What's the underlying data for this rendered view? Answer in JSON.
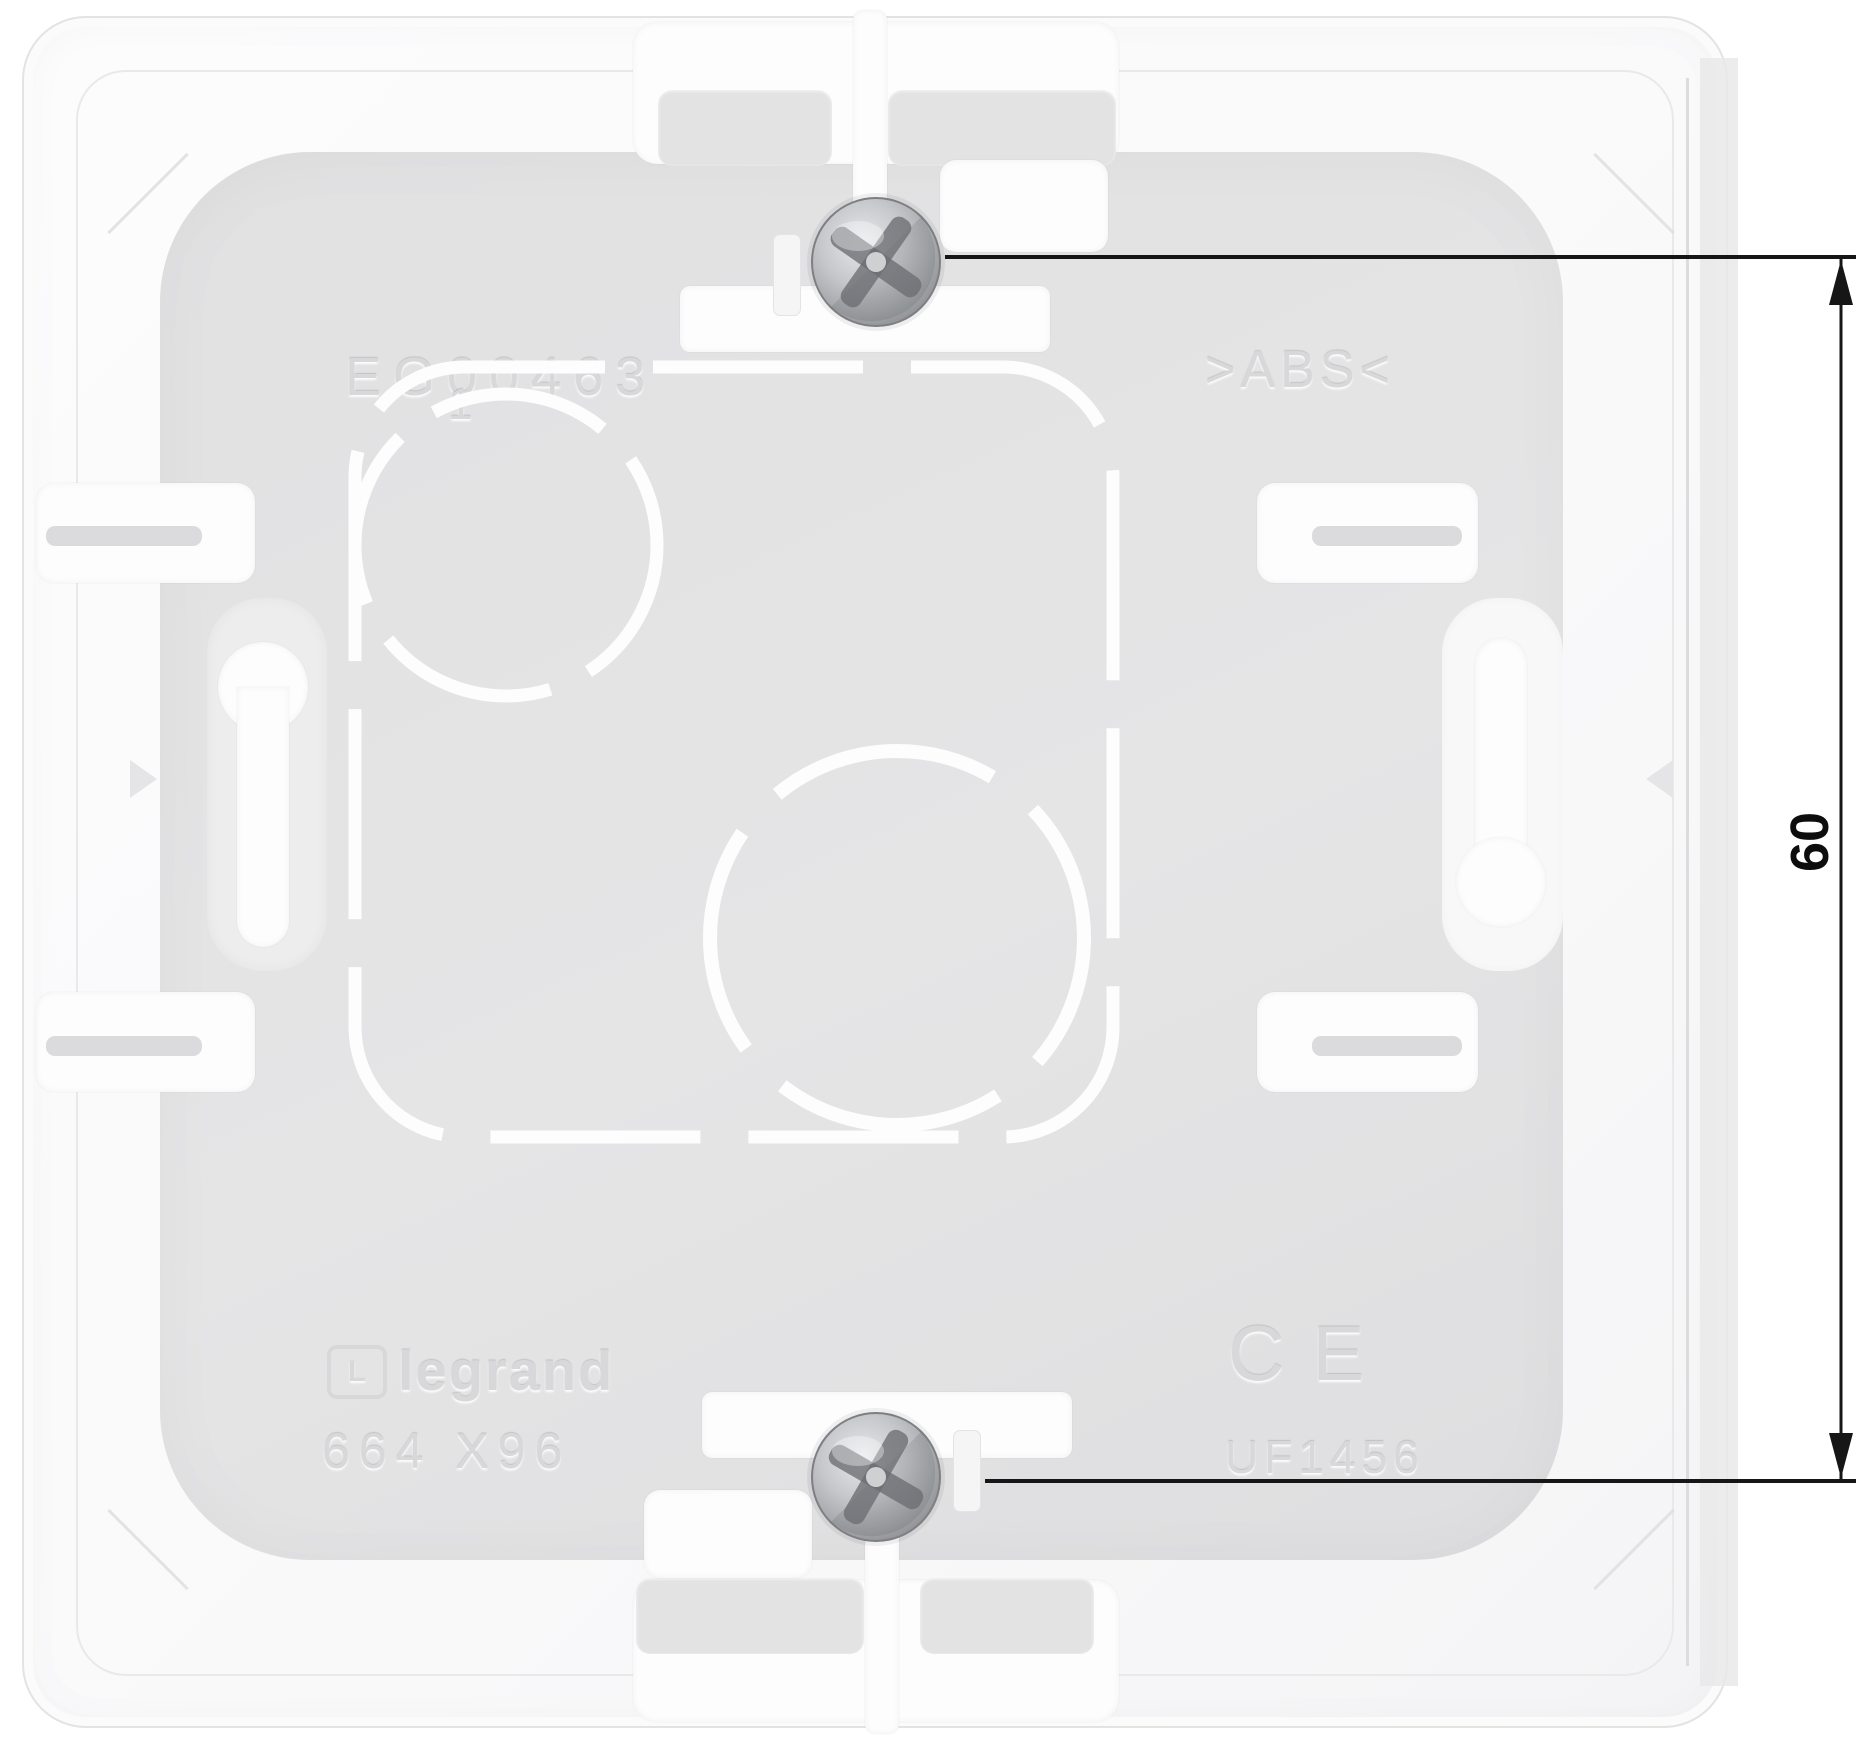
{
  "photo": {
    "description": "white flush-mounting electrical back box, rear view",
    "markings": {
      "model_code": "EG00463",
      "quantity_mark": "1",
      "material_mark": ">ABS<",
      "brand": "legrand",
      "brand_logo_letter": "L",
      "reference_code": "664 X96",
      "ce_mark": "CE",
      "batch_code": "UF1456"
    },
    "dimension": {
      "label": "60"
    },
    "colors": {
      "plastic_white": "#fbfbfc",
      "plastic_gray": "#e3e3e4",
      "screw_metal": "#9ea0a3",
      "dimension_line": "#161616"
    }
  }
}
